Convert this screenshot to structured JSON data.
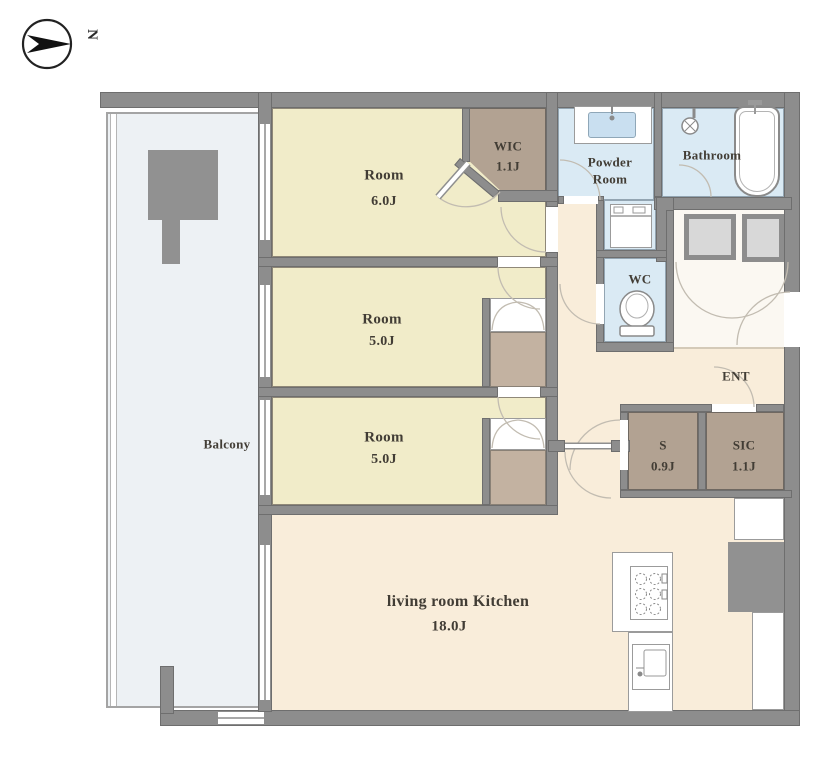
{
  "compass": {
    "north_label": "N"
  },
  "rooms": {
    "room_6": {
      "name": "Room",
      "area": "6.0J"
    },
    "wic": {
      "name": "WIC",
      "area": "1.1J"
    },
    "powder_room": {
      "name_line1": "Powder",
      "name_line2": "Room"
    },
    "bathroom": {
      "name": "Bathroom"
    },
    "wc": {
      "name": "WC"
    },
    "entrance": {
      "name": "ENT"
    },
    "room_5a": {
      "name": "Room",
      "area": "5.0J"
    },
    "room_5b": {
      "name": "Room",
      "area": "5.0J"
    },
    "storage_s": {
      "name": "S",
      "area": "0.9J"
    },
    "sic": {
      "name": "SIC",
      "area": "1.1J"
    },
    "balcony": {
      "name": "Balcony"
    },
    "living_kitchen": {
      "name": "living room  Kitchen",
      "area": "18.0J"
    }
  },
  "colors": {
    "wall": "#8d8d8d",
    "room_cream": "#f1ecc9",
    "hall_peach": "#f9edda",
    "wet_blue": "#daeaf4",
    "closet_brown": "#b2a292",
    "closet_light": "#c3b2a1",
    "balcony_gray": "#edf1f4",
    "pipe_gray": "#d8d8d8",
    "pillar_gray": "#919191",
    "corridor_white": "#fbf8f2",
    "fixture_white": "#ffffff",
    "basin_blue": "#c9dff0",
    "label_text": "#423d35",
    "arc_line": "#c2bcb1"
  }
}
